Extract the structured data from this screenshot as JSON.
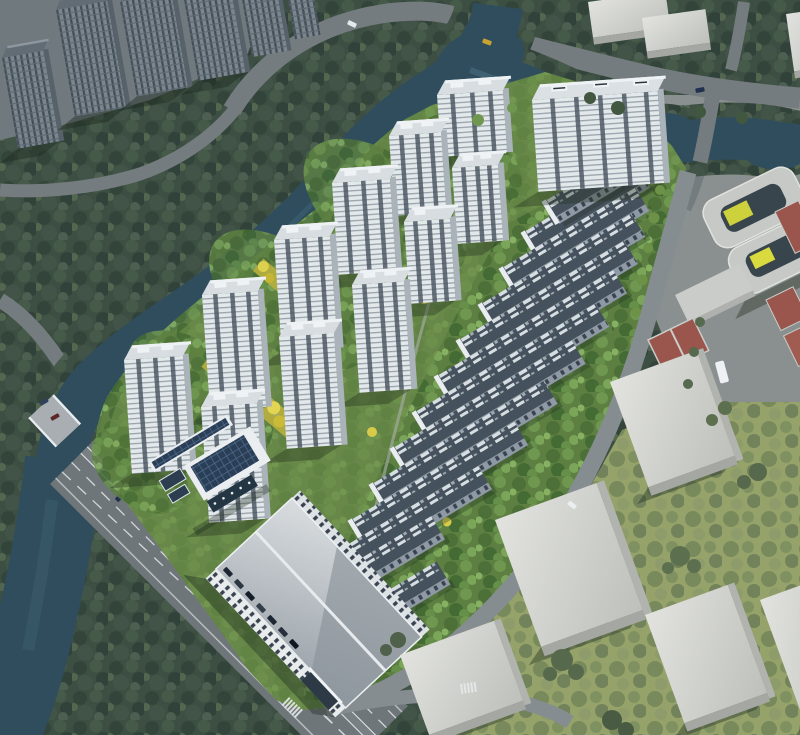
{
  "meta": {
    "type": "architectural-aerial-rendering",
    "description": "Bird's-eye architectural rendering of a riverside residential development: a dozen white high-rise apartment towers and thirteen diagonal rows of low-rise townhouses with dark solar-panel roofs sit in bright green landscaping with golden tree-lined walks. A dark teal river wraps the site on the north and west, a wide multi-lane boulevard with dashed lanes and cars runs along the southwest, a school campus with double-courtyard building and red basketball courts lies to the east, and plain grey context massing blocks with olive lawns fill the southeast. Dark grey context towers occupy the top-left corner."
  },
  "palette": {
    "water": "#2f4d5d",
    "forest": "#3d5042",
    "lawn": "#6b8c4a",
    "roadMajor": "#6f767a",
    "roadContext": "#757c7f",
    "roadSite": "#868d91",
    "laneLine": "#e3e7e9",
    "towerFacade": "#e2e7ea",
    "towerRoof": "#d7dde1",
    "towerStrip": "#49545f",
    "towerSide": "#aab3ba",
    "rowRoof": "#46515e",
    "rowPanel": "#d7dee3",
    "rowFacade": "#8e99a5",
    "blockTop": "#d8d9d5",
    "blockSide": "#a5a7a3",
    "olive": "#95a26a",
    "plaza": "#8a9090",
    "courtRed": "#9a564c",
    "golden": "#d9cb4a",
    "pv": "#2a3e56",
    "glass": "#243643",
    "accentYellow": "#ccd13c"
  },
  "scene": {
    "elements": [
      {
        "name": "river",
        "count": 1
      },
      {
        "name": "pond",
        "count": 2
      },
      {
        "name": "boulevard-road",
        "count": 1
      },
      {
        "name": "bridge",
        "count": 1
      },
      {
        "name": "residential-tower",
        "count": 12
      },
      {
        "name": "townhouse-row",
        "count": 13
      },
      {
        "name": "golden-tree-path",
        "count": 2
      },
      {
        "name": "commercial-building",
        "count": 1
      },
      {
        "name": "solar-canopy-building",
        "count": 1
      },
      {
        "name": "school-building",
        "count": 1
      },
      {
        "name": "basketball-court",
        "count": 4
      },
      {
        "name": "context-tower",
        "count": 6
      },
      {
        "name": "context-block",
        "count": 8
      },
      {
        "name": "car",
        "count": 16
      },
      {
        "name": "crosswalk",
        "count": 2
      }
    ]
  }
}
